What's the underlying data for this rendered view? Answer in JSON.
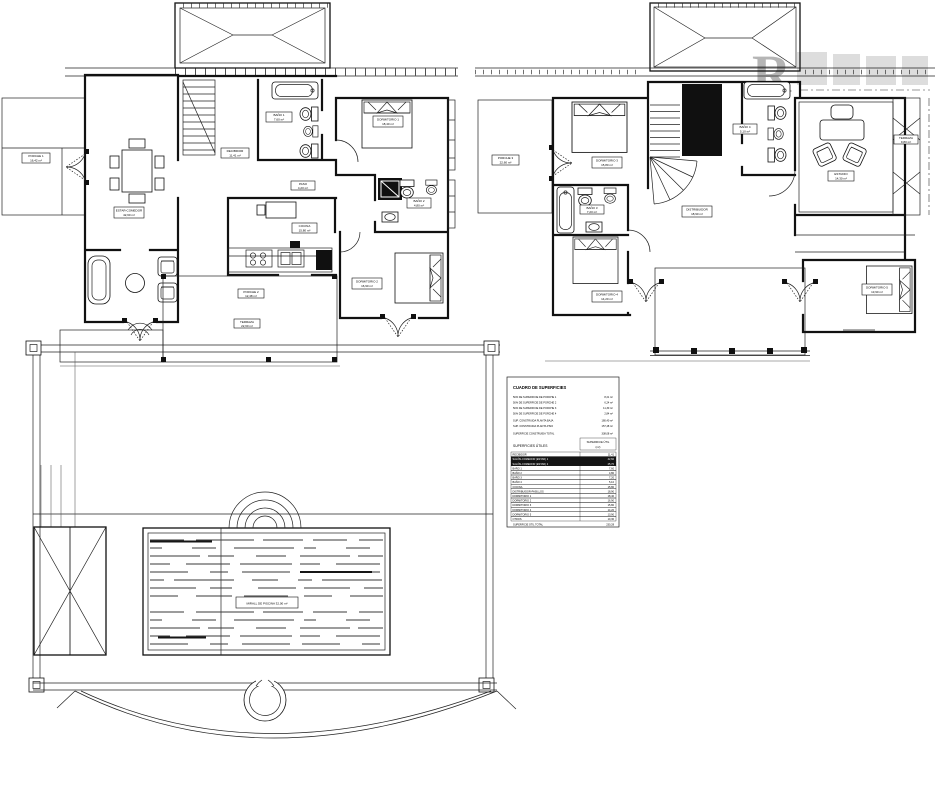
{
  "watermark": {
    "letter": "R"
  },
  "pool": {
    "label": "MIRALL DE PISCINA 32,00 m²"
  },
  "ground_floor": {
    "labels": {
      "porche1": {
        "name": "PORCHE 1",
        "area": "16,42 m²"
      },
      "estar": {
        "name": "ESTAR-COMEDOR",
        "area": "42,60 m²"
      },
      "recibidor": {
        "name": "RECIBIDOR",
        "area": "11,41 m²"
      },
      "paso": {
        "name": "PASO",
        "area": "4,20 m²"
      },
      "cocina": {
        "name": "COCINA",
        "area": "15,80 m²"
      },
      "bano1": {
        "name": "BAÑO 1",
        "area": "7,60 m²"
      },
      "bano2": {
        "name": "BAÑO 2",
        "area": "4,80 m²"
      },
      "dorm1": {
        "name": "DORMITORIO 1",
        "area": "18,40 m²"
      },
      "dorm2": {
        "name": "DORMITORIO 2",
        "area": "16,90 m²"
      },
      "porche2": {
        "name": "PORCHE 2",
        "area": "12,48 m²"
      },
      "terraza": {
        "name": "TERRAZA",
        "area": "22,60 m²"
      }
    }
  },
  "first_floor": {
    "labels": {
      "porche3": {
        "name": "PORCHE 3",
        "area": "22,60 m²"
      },
      "dorm3": {
        "name": "DORMITORIO 3",
        "area": "15,80 m²"
      },
      "dorm4": {
        "name": "DORMITORIO 4",
        "area": "14,20 m²"
      },
      "dorm5": {
        "name": "DORMITORIO 5",
        "area": "13,90 m²"
      },
      "bano3": {
        "name": "BAÑO 3",
        "area": "7,20 m²"
      },
      "bano4": {
        "name": "BAÑO 4",
        "area": "5,10 m²"
      },
      "estudio": {
        "name": "ESTUDIO",
        "area": "14,30 m²"
      },
      "distribuidor": {
        "name": "DISTRIBUIDOR",
        "area": "18,90 m²"
      },
      "terraza2": {
        "name": "TERRAZA",
        "area": "9,80 m²"
      }
    }
  },
  "areas_table": {
    "title": "CUADRO DE SUPERFICIES",
    "summary_rows": [
      {
        "label": "50% DE SUPERFICIE DE PORCHE 1",
        "value": "8,21 m²"
      },
      {
        "label": "50% DE SUPERFICIE DE PORCHE 2",
        "value": "6,24 m²"
      },
      {
        "label": "50% DE SUPERFICIE DE PORCHE 3",
        "value": "11,30 m²"
      },
      {
        "label": "50% DE SUPERFICIE DE PORCHE 4",
        "value": "2,84 m²"
      },
      {
        "label": "SUP. CONSTRUIDA PLANTA BAJA",
        "value": "180,40 m²"
      },
      {
        "label": "SUP. CONSTRUIDA PLANTA PISO",
        "value": "157,48 m²"
      },
      {
        "label": "SUPERFICIE CONSTRUIDA TOTAL",
        "value": "338,08 m²"
      }
    ],
    "useful_section_label": "SUPERFICIES ÚTILES",
    "useful_col_header_line1": "SUPERFICIE ÚTIL",
    "useful_col_header_line2": "(m²)",
    "rows": [
      {
        "name": "RECIBIDOR",
        "value": "11,41"
      },
      {
        "name": "SALÓN-COMEDOR (ESTAR) 1",
        "value": "42,60"
      },
      {
        "name": "SALÓN-COMEDOR (ESTAR) 2",
        "value": "25,70"
      },
      {
        "name": "BAÑO 1",
        "value": "7,60"
      },
      {
        "name": "BAÑO 2",
        "value": "4,80"
      },
      {
        "name": "BAÑO 3",
        "value": "7,20"
      },
      {
        "name": "BAÑO 4",
        "value": "5,10"
      },
      {
        "name": "COCINA",
        "value": "15,80"
      },
      {
        "name": "DISTRIBUIDOR-PASILLOS",
        "value": "18,90"
      },
      {
        "name": "DORMITORIO 1",
        "value": "18,40"
      },
      {
        "name": "DORMITORIO 2",
        "value": "16,90"
      },
      {
        "name": "DORMITORIO 3",
        "value": "15,80"
      },
      {
        "name": "DORMITORIO 4",
        "value": "14,20"
      },
      {
        "name": "DORMITORIO 5",
        "value": "13,90"
      },
      {
        "name": "OTROS",
        "value": "10,30"
      }
    ],
    "total_label": "SUPERFICIE ÚTIL TOTAL",
    "total_value": "230,28"
  }
}
